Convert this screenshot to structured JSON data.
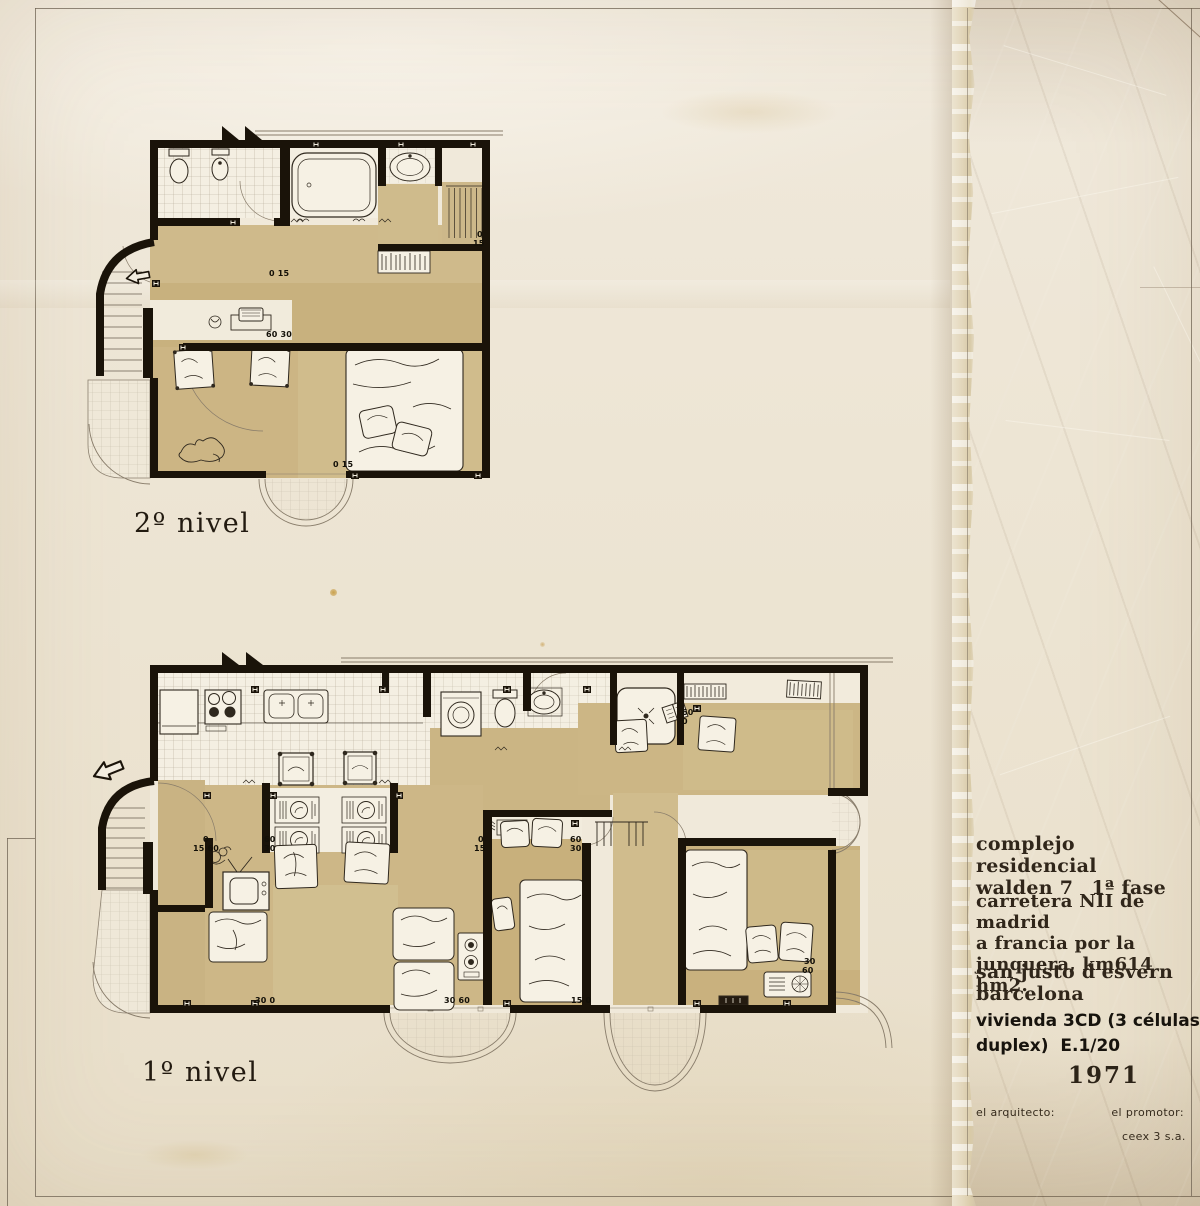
{
  "plans": {
    "upper": {
      "label": "2º nivel",
      "dims": [
        {
          "t": "0",
          "x": 477,
          "y": 231
        },
        {
          "t": "15",
          "x": 473,
          "y": 240
        },
        {
          "t": "0 15",
          "x": 269,
          "y": 270
        },
        {
          "t": "60 30",
          "x": 266,
          "y": 331
        },
        {
          "t": "0 15",
          "x": 333,
          "y": 461
        }
      ]
    },
    "lower": {
      "label": "1º nivel",
      "dims": [
        {
          "t": "0",
          "x": 203,
          "y": 836
        },
        {
          "t": "15 60",
          "x": 193,
          "y": 845
        },
        {
          "t": "60",
          "x": 264,
          "y": 836
        },
        {
          "t": "30",
          "x": 264,
          "y": 845
        },
        {
          "t": "0",
          "x": 478,
          "y": 836
        },
        {
          "t": "15",
          "x": 474,
          "y": 845
        },
        {
          "t": "60",
          "x": 570,
          "y": 836
        },
        {
          "t": "30",
          "x": 570,
          "y": 845
        },
        {
          "t": "60",
          "x": 682,
          "y": 709
        },
        {
          "t": "0",
          "x": 682,
          "y": 718
        },
        {
          "t": "30 0",
          "x": 255,
          "y": 997
        },
        {
          "t": "30 60",
          "x": 444,
          "y": 997
        },
        {
          "t": "15 0",
          "x": 571,
          "y": 997
        },
        {
          "t": "30",
          "x": 804,
          "y": 958
        },
        {
          "t": "60",
          "x": 802,
          "y": 967
        }
      ]
    }
  },
  "title_block": {
    "line1": "complejo residencial",
    "line2_left": "walden 7",
    "line2_right": "1ª fase",
    "line3": "carretera NII de madrid",
    "line4": "a francia por la",
    "line5": "junquera, km614 hm2.",
    "line6": "san justo d'esvern",
    "line7": "barcelona",
    "line8": "vivienda 3CD (3 células en",
    "line9": "duplex)  E.1/20",
    "year": "1971",
    "architect_label": "el arquitecto:",
    "promoter_label": "el promotor:",
    "promoter_name": "ceex 3 s.a."
  },
  "colors": {
    "paper": "#ece4d2",
    "kraft": "#a8885b",
    "wash": "#c9b281",
    "ink": "#1a1309"
  }
}
